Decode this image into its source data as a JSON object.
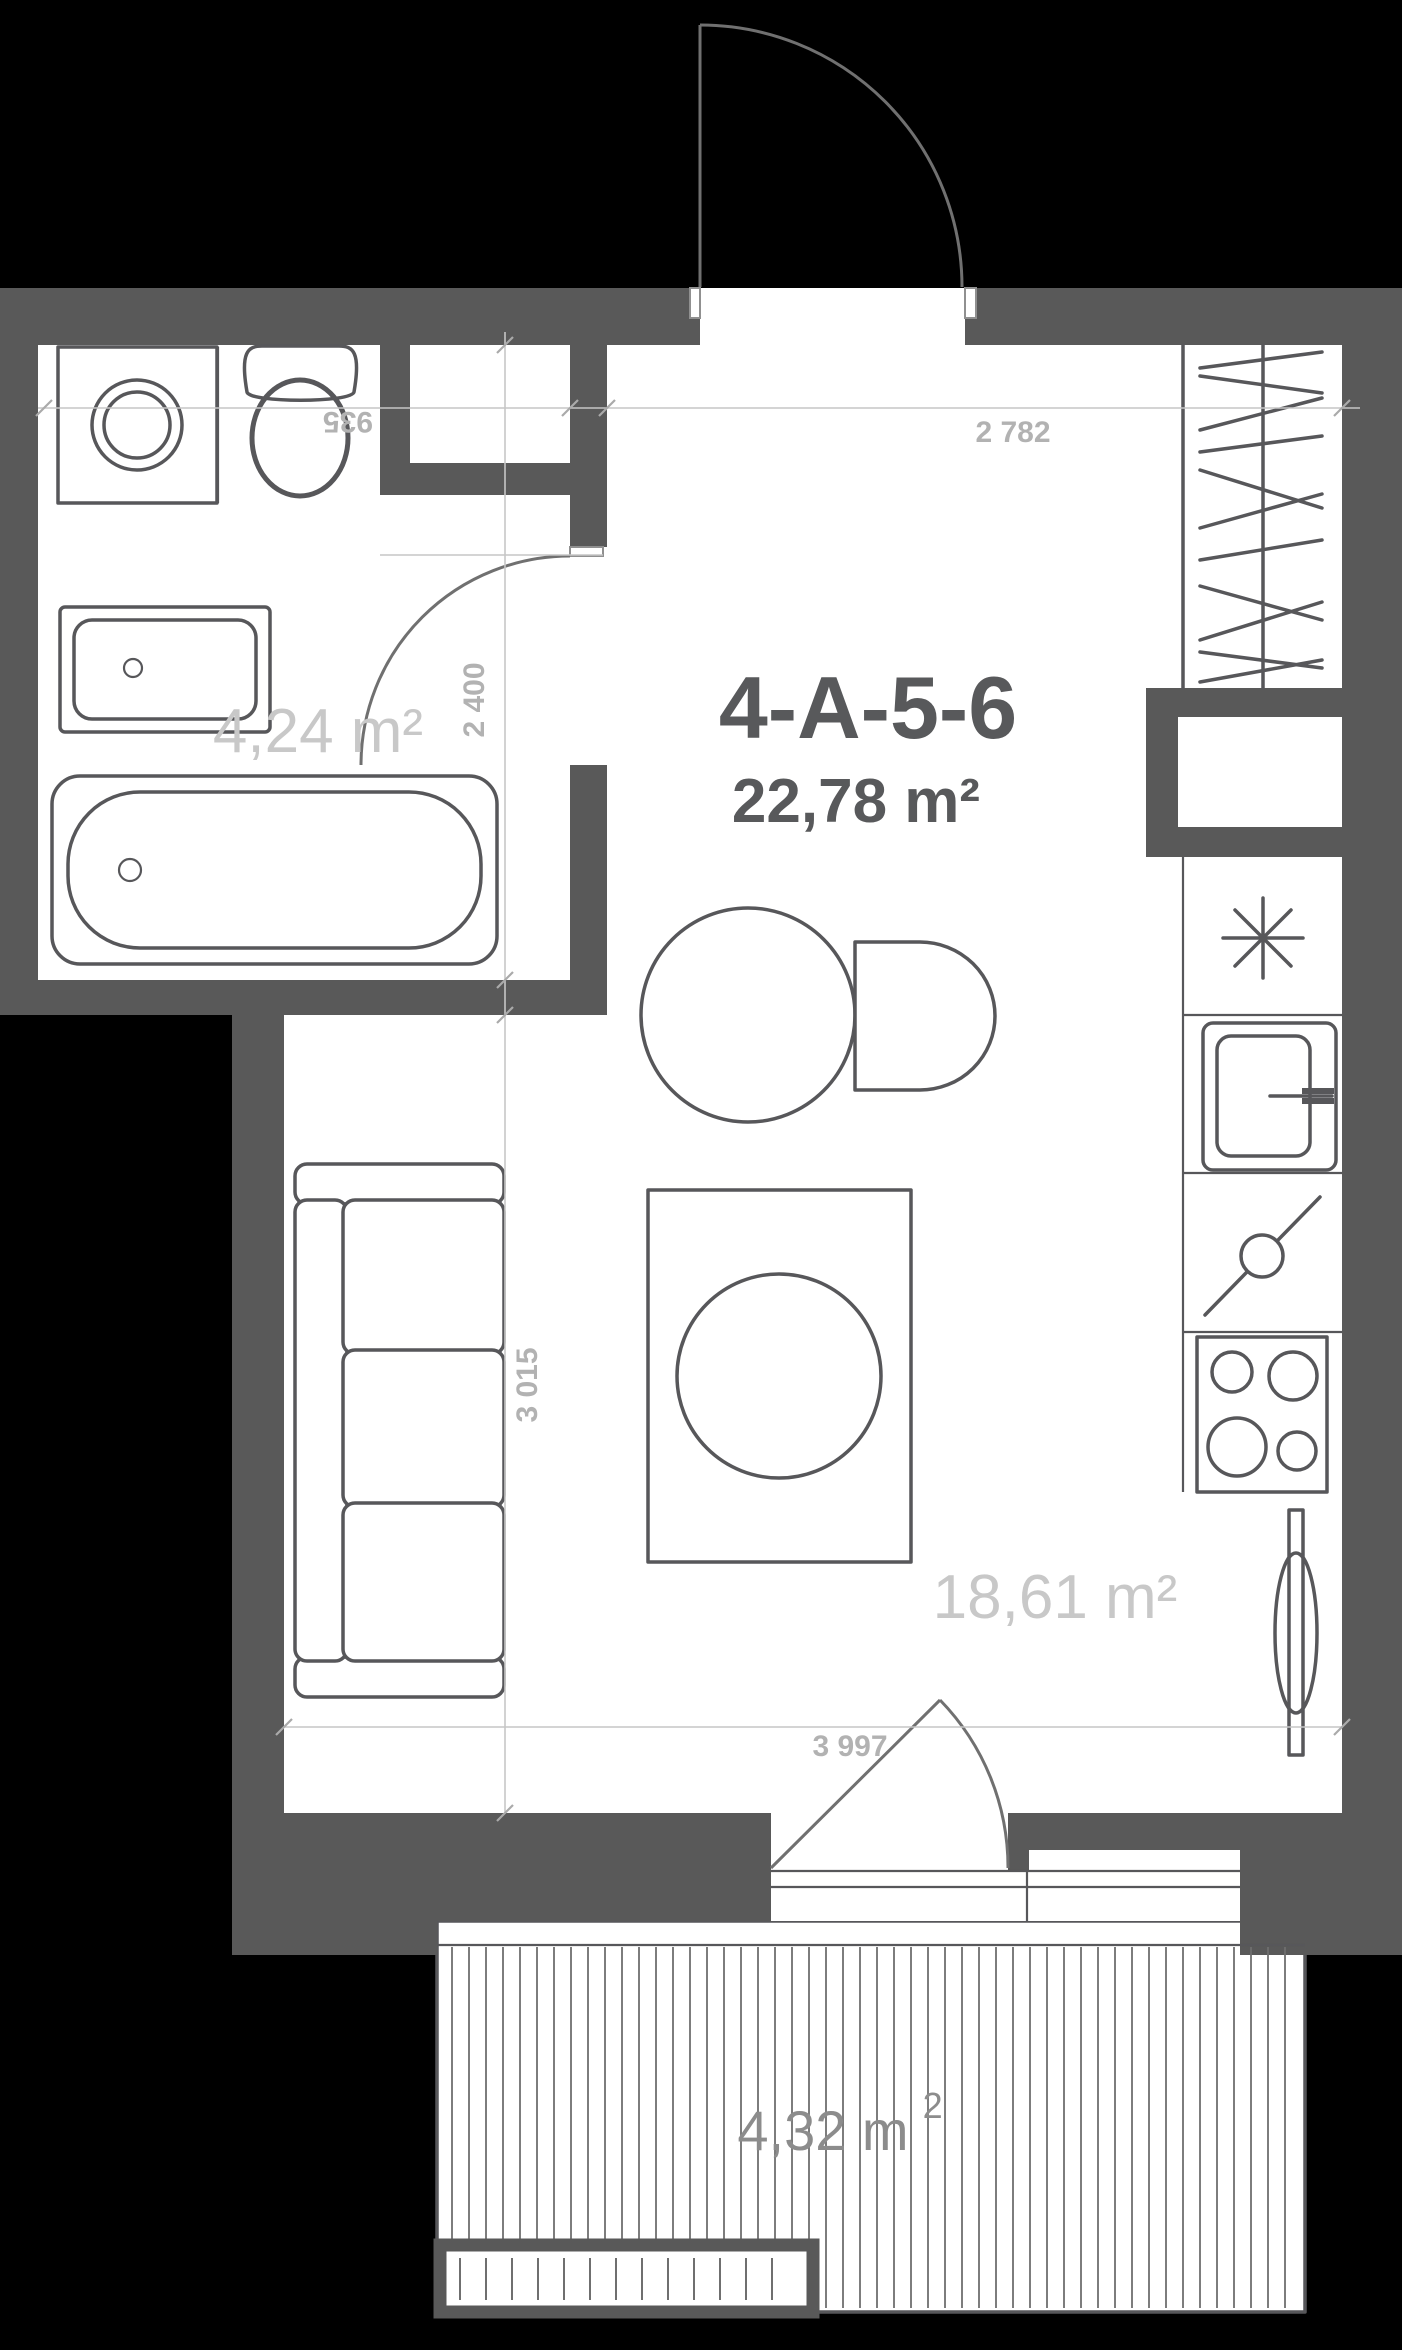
{
  "plan": {
    "unit_title": "4-A-5-6",
    "unit_area": "22,78 m²",
    "rooms": [
      {
        "id": "bathroom",
        "label": "4,24 m²"
      },
      {
        "id": "living-room",
        "label": "18,61 m²"
      },
      {
        "id": "balcony",
        "label": "4,32 m",
        "label_sup": "2"
      }
    ],
    "dimensions": {
      "toilet_width": "935",
      "hall_width": "2 782",
      "bathroom_depth": "2 400",
      "living_depth": "3 015",
      "living_width": "3 997"
    },
    "fixtures": [
      "entry-door",
      "bathroom-door",
      "balcony-door",
      "window",
      "washing-machine",
      "toilet",
      "bathroom-sink",
      "bathtub",
      "wardrobe",
      "duct-shaft",
      "refrigerator",
      "kitchen-sink",
      "countertop",
      "stove",
      "radiator",
      "sofa",
      "rug-with-table",
      "dining-table",
      "dining-chair",
      "balcony-deck",
      "planter-box"
    ],
    "colors": {
      "wall": "#595959",
      "line": "#57575a",
      "door": "#707070",
      "dim_line": "#c6c6c6",
      "dim_text": "#b2b2b2",
      "area_label": "#c8c8c8",
      "balcony_label": "#8c8c8c",
      "title": "#58595b",
      "hatch": "#6f6f6f",
      "background": "#000000"
    }
  }
}
